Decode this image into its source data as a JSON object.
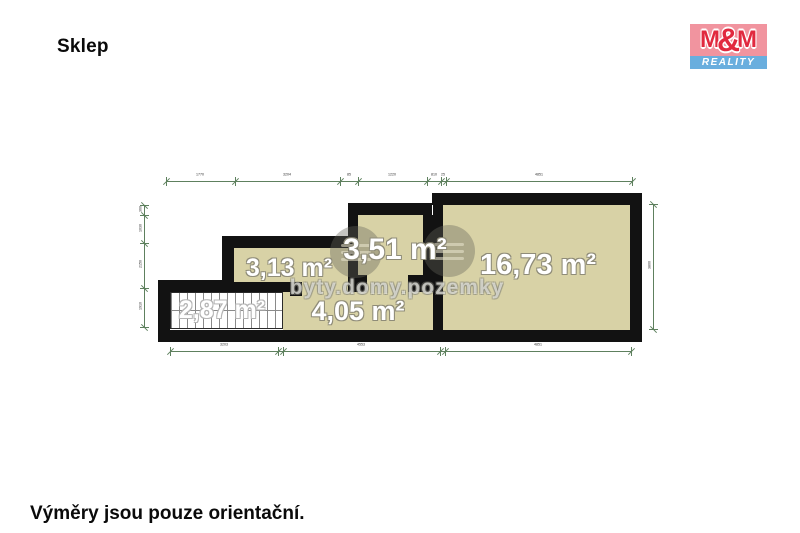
{
  "title": "Sklep",
  "footer_note": "Výměry jsou pouze orientační.",
  "logo": {
    "m_left": "M",
    "ampersand": "&",
    "m_right": "M",
    "reality": "REALITY"
  },
  "watermark_text": "byty.domy.pozemky",
  "rooms": [
    {
      "id": "staircase-cellar",
      "area_label": "2,87 m²",
      "type": "staircase"
    },
    {
      "id": "cellar-313",
      "area_label": "3,13 m²",
      "type": "cellar"
    },
    {
      "id": "cellar-351",
      "area_label": "3,51 m²",
      "type": "cellar"
    },
    {
      "id": "cellar-1673",
      "area_label": "16,73 m²",
      "type": "cellar"
    },
    {
      "id": "corridor-405",
      "area_label": "4,05 m²",
      "type": "corridor"
    }
  ],
  "dimensions": {
    "top": [
      "1770",
      "3204",
      "85",
      "1220",
      "810",
      "25",
      "4851"
    ],
    "bottom": [
      "3203",
      "4553",
      "4851"
    ],
    "left": [
      "360",
      "1030",
      "2150",
      "1910"
    ],
    "right": [
      "3800"
    ]
  },
  "colors": {
    "wall": "#121212",
    "room_fill": "#d8d2a6",
    "dimension_line": "#5e805e",
    "logo_pink": "#f1949f",
    "logo_red": "#e1293f",
    "logo_blue": "#69aede"
  }
}
